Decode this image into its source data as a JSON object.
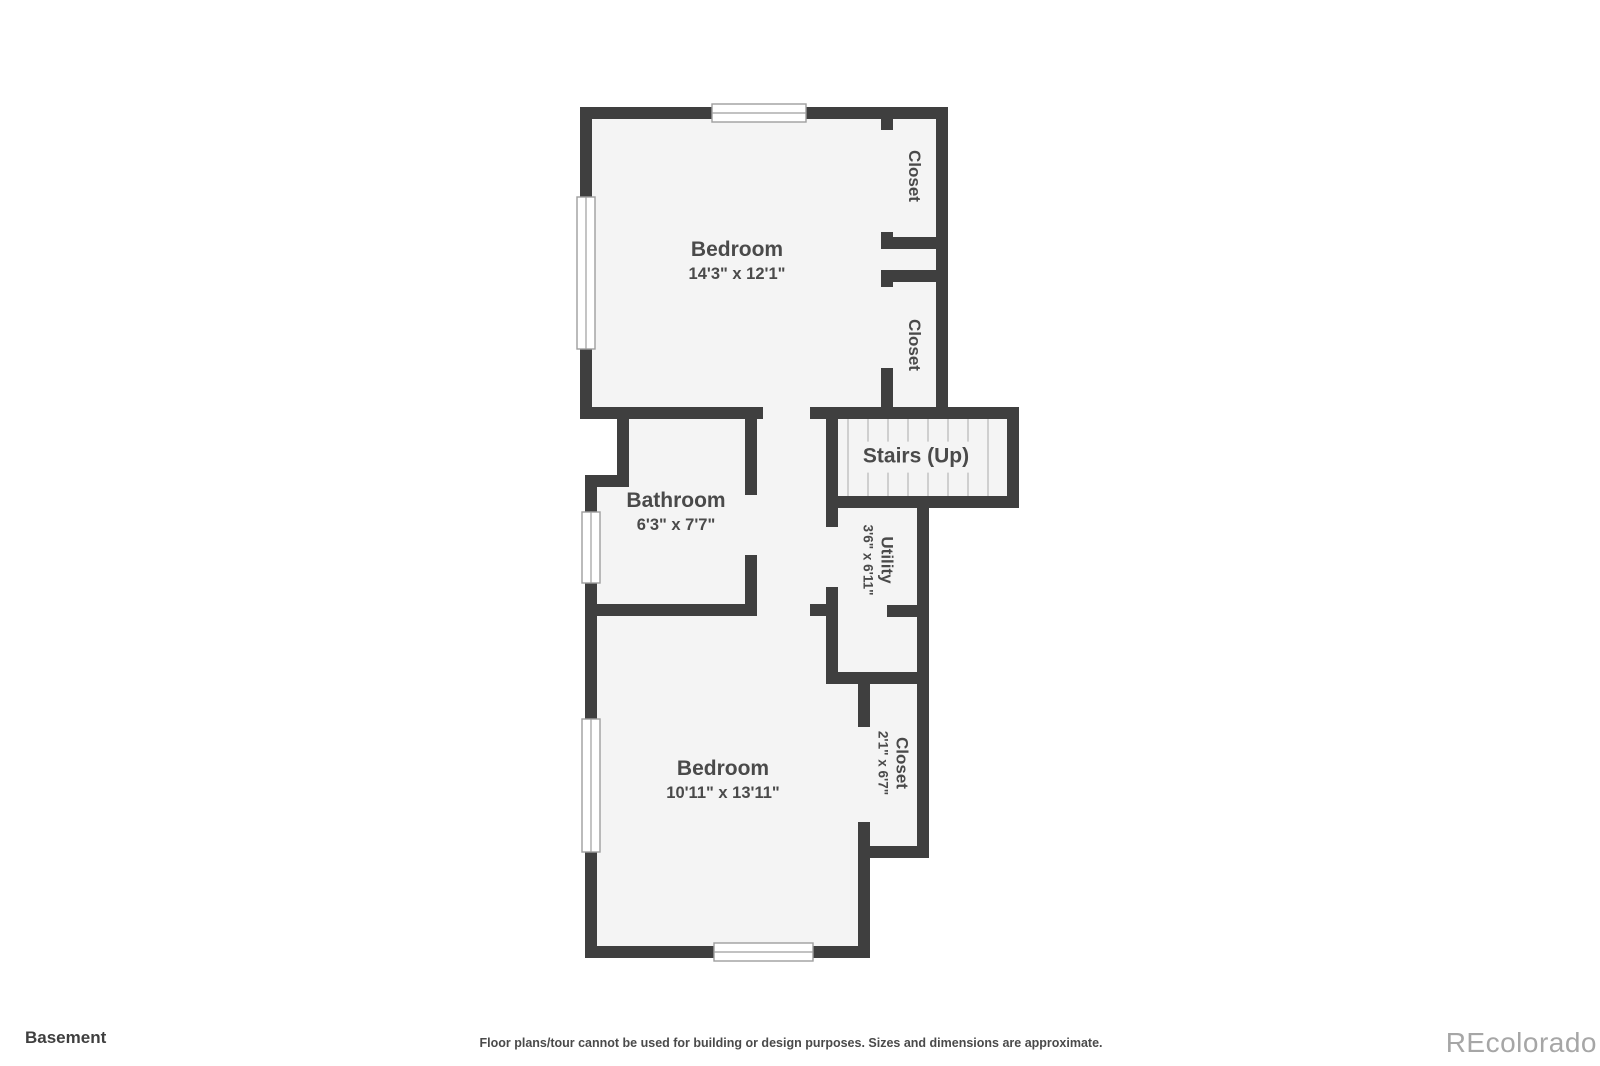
{
  "floor": {
    "title": "Basement"
  },
  "rooms": [
    {
      "id": "bedroom-top",
      "name": "Bedroom",
      "dims": "14'3\" x 12'1\""
    },
    {
      "id": "closet-top-1",
      "name": "Closet",
      "dims": ""
    },
    {
      "id": "closet-top-2",
      "name": "Closet",
      "dims": ""
    },
    {
      "id": "stairs",
      "name": "Stairs (Up)",
      "dims": ""
    },
    {
      "id": "utility",
      "name": "Utility",
      "dims": "3'6\" x 6'11\""
    },
    {
      "id": "bathroom",
      "name": "Bathroom",
      "dims": "6'3\" x 7'7\""
    },
    {
      "id": "bedroom-bottom",
      "name": "Bedroom",
      "dims": "10'11\" x 13'11\""
    },
    {
      "id": "closet-bottom",
      "name": "Closet",
      "dims": "2'1\" x 6'7\""
    }
  ],
  "footer": {
    "floor_label": "Basement",
    "disclaimer": "Floor plans/tour cannot be used for building or design purposes. Sizes and dimensions are approximate.",
    "brand": "REcolorado"
  },
  "colors": {
    "wall": "#3f3f3f",
    "room": "#f4f4f4",
    "label": "#4a4a4a",
    "tread": "#cfcfcf",
    "frame": "#9e9e9e",
    "footer": "#4a4a4a",
    "brand": "#a6a6a6"
  }
}
